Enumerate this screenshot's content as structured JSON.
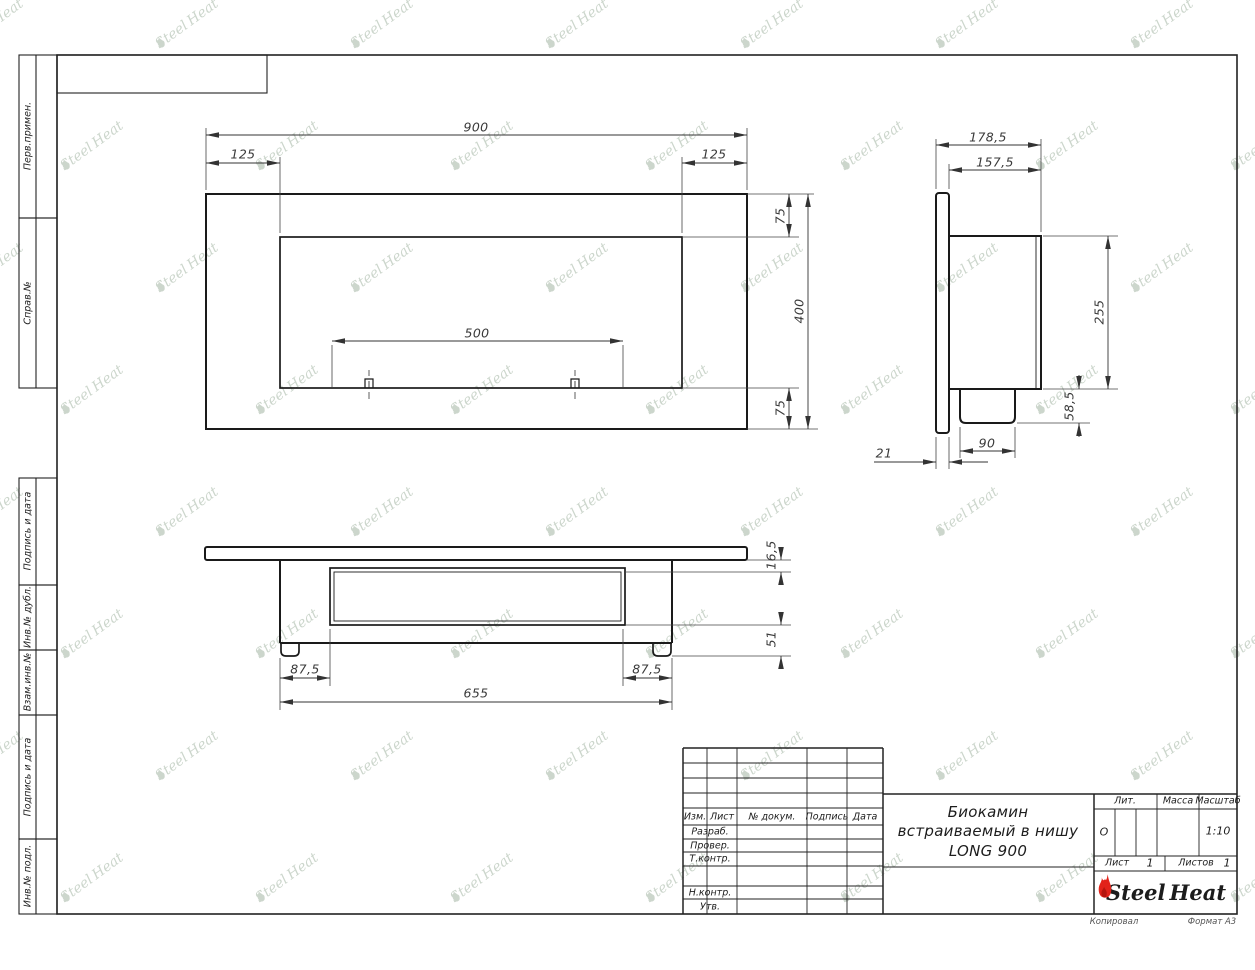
{
  "page": {
    "footer_copy": "Копировал",
    "footer_format": "Формат А3"
  },
  "margin": {
    "labels": [
      "Перв.примен.",
      "Справ.№",
      "Подпись и дата",
      "Инв.№ дубл.",
      "Взам.инв.№",
      "Подпись и дата",
      "Инв.№ подл."
    ]
  },
  "title_block": {
    "cols": [
      "Изм.",
      "Лист",
      "№ докум.",
      "Подпись",
      "Дата"
    ],
    "rows": [
      "Разраб.",
      "Провер.",
      "Т.контр.",
      "Н.контр.",
      "Утв."
    ],
    "doc_title_line1": "Биокамин",
    "doc_title_line2": "встраиваемый в нишу",
    "doc_title_line3": "LONG 900",
    "lit_label": "Лит.",
    "lit_value": "О",
    "mass_label": "Масса",
    "scale_label": "Масштаб",
    "scale_value": "1:10",
    "sheet_label": "Лист",
    "sheet_value": "1",
    "sheets_label": "Листов",
    "sheets_value": "1",
    "brand_left": "Steel",
    "brand_right": "Heat",
    "brand_color": "#e2231a"
  },
  "watermark": {
    "left": "Steel",
    "right": "Heat"
  },
  "dims": {
    "front": {
      "width": "900",
      "offset_left": "125",
      "offset_right": "125",
      "top": "75",
      "height": "400",
      "bottom": "75",
      "burner": "500"
    },
    "side": {
      "depth": "178,5",
      "inner_depth": "157,5",
      "body_height": "255",
      "burner_height": "58,5",
      "burner_width": "90",
      "flange": "21"
    },
    "bottom": {
      "lip": "16,5",
      "inset_left": "87,5",
      "inset_right": "87,5",
      "length": "655",
      "foot": "51"
    }
  }
}
